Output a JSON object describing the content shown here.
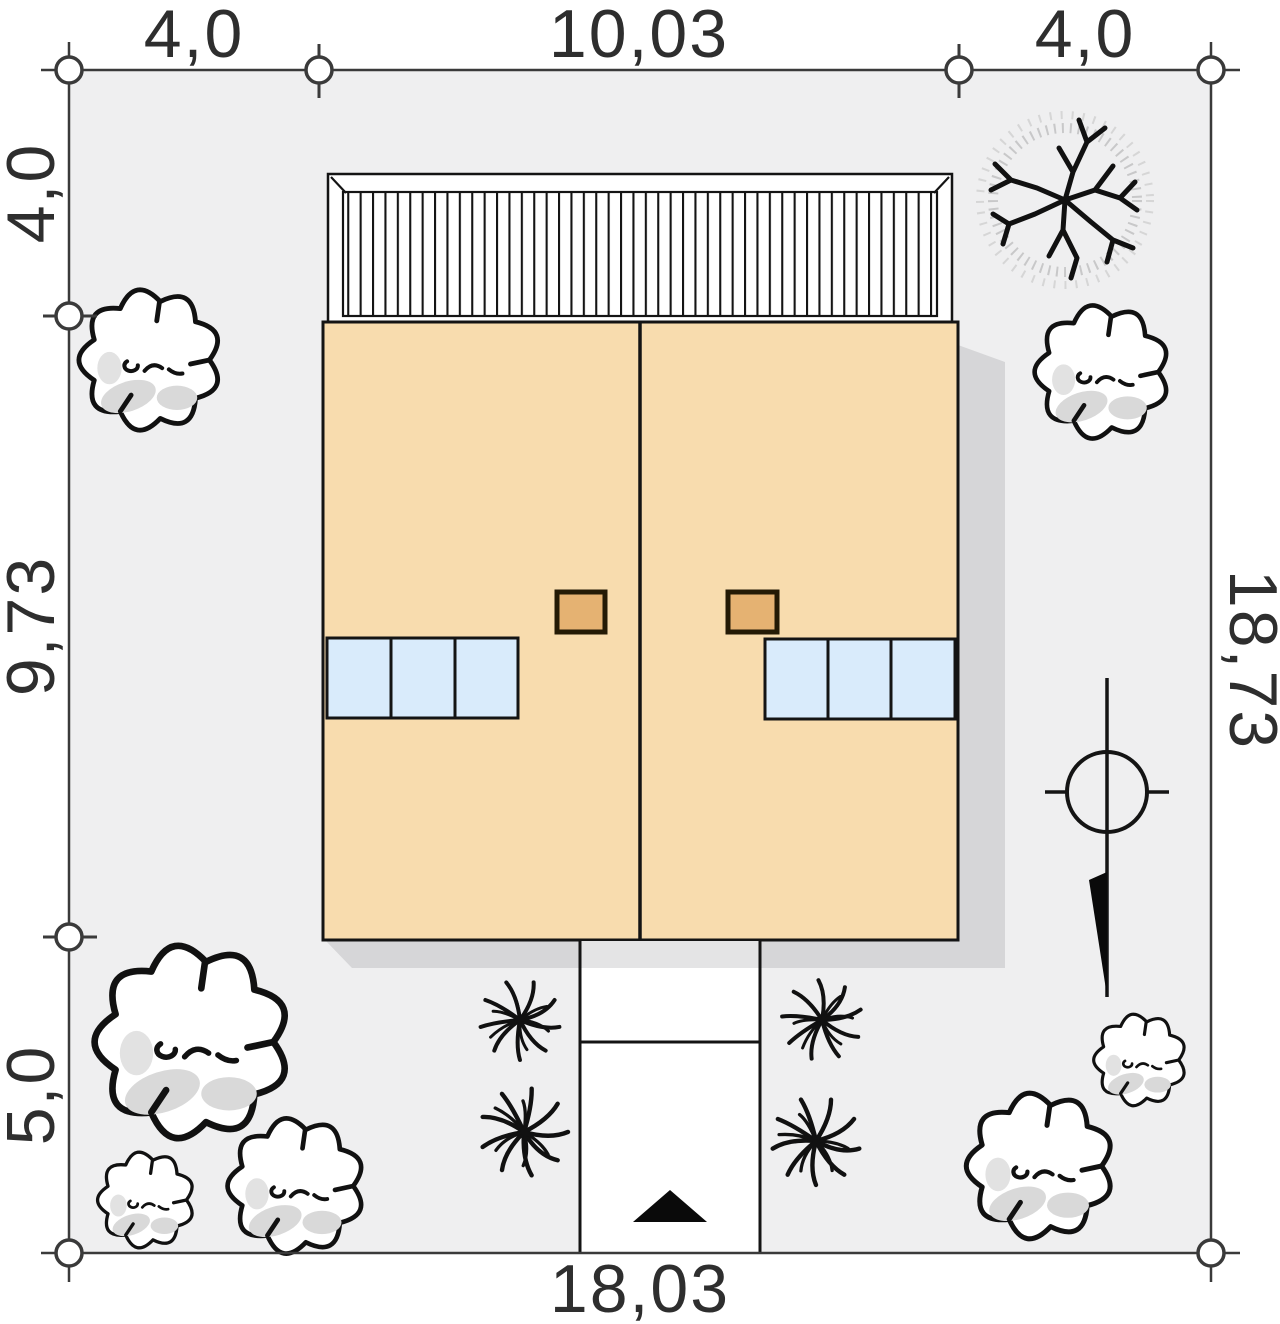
{
  "title": "house-site-plan",
  "dims": {
    "top_left": "4,0",
    "top_middle": "10,03",
    "top_right": "4,0",
    "left_top": "4,0",
    "left_middle": "9,73",
    "left_bottom": "5,0",
    "right_side": "18,73",
    "bottom": "18,03"
  },
  "colors": {
    "plot_fill": "#efeff0",
    "border_line": "#3a3a3a",
    "house_line": "#141414",
    "roof": "#f8dcae",
    "chimney": "#e5b272",
    "chimney_border": "#241a05",
    "skylight": "#d9ebfb",
    "terrace": "#ffffff",
    "shadow": "#d6d6d8",
    "driveway": "#ffffff",
    "driveway_shade": "#e4e4e5",
    "vegetation_outline": "#111111",
    "vegetation_fill": "#ffffff",
    "vegetation_shade": "#d9d9d9",
    "stipple": "#9a9a9a",
    "marker_fill": "#ffffff",
    "text": "#2e2e2e",
    "entrance_arrow": "#0a0a0a"
  }
}
